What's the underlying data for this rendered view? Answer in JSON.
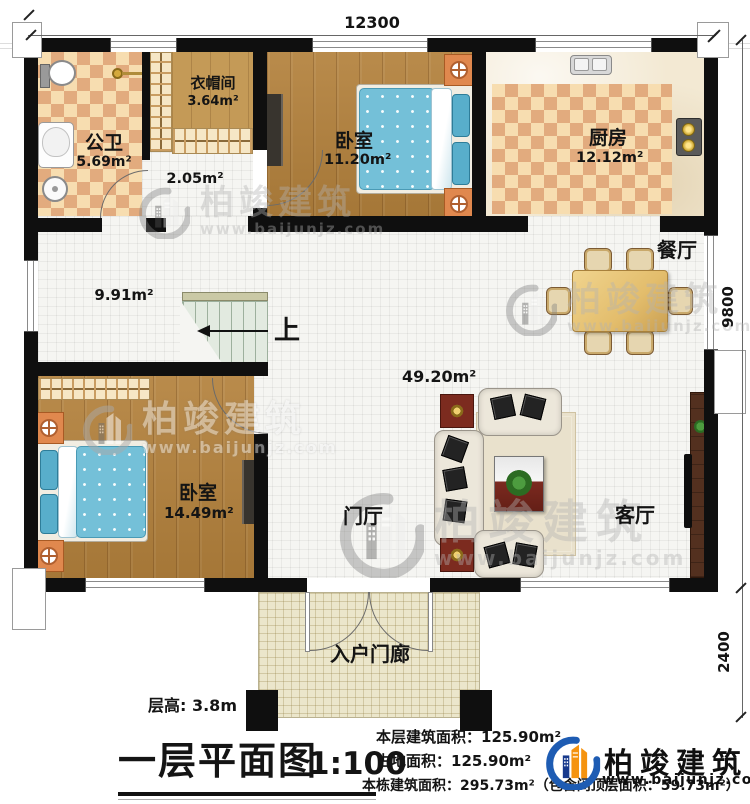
{
  "dimensions": {
    "width_top": "12300",
    "height_right": "9800",
    "porch_height": "2400"
  },
  "rooms": {
    "bathroom_name": "公卫",
    "bathroom_area": "5.69m²",
    "cloakroom_name": "衣帽间",
    "cloakroom_area": "3.64m²",
    "hallway_area": "2.05m²",
    "bedroom_top_name": "卧室",
    "bedroom_top_area": "11.20m²",
    "kitchen_name": "厨房",
    "kitchen_area": "12.12m²",
    "dining_name": "餐厅",
    "corridor_area": "9.91m²",
    "stairs_up_label": "上",
    "bedroom_bottom_name": "卧室",
    "bedroom_bottom_area": "14.49m²",
    "foyer_name": "门厅",
    "living_name": "客厅",
    "living_area": "49.20m²",
    "porch_name": "入户门廊"
  },
  "titleblock": {
    "floor_height": "层高: 3.8m",
    "title": "一层平面图",
    "scale": "1:100",
    "stat_floor_area": "本层建筑面积：125.90m²",
    "stat_land_area": "占地面积：125.90m²",
    "stat_total_area": "本栋建筑面积：295.73m²（包含闷顶层面积：59.73m²）"
  },
  "brand": {
    "name": "柏竣建筑",
    "website": "www.baijunjz.com"
  },
  "watermark": {
    "name": "柏竣建筑",
    "website": "www.baijunjz.com"
  },
  "colors": {
    "wall": "#0f0f0f",
    "brand_blue": "#1e5cb3",
    "brand_orange": "#f5930f",
    "wood": "#b3813c",
    "checker_light": "#f7ddb0",
    "checker_dark": "#e2ab7e"
  }
}
